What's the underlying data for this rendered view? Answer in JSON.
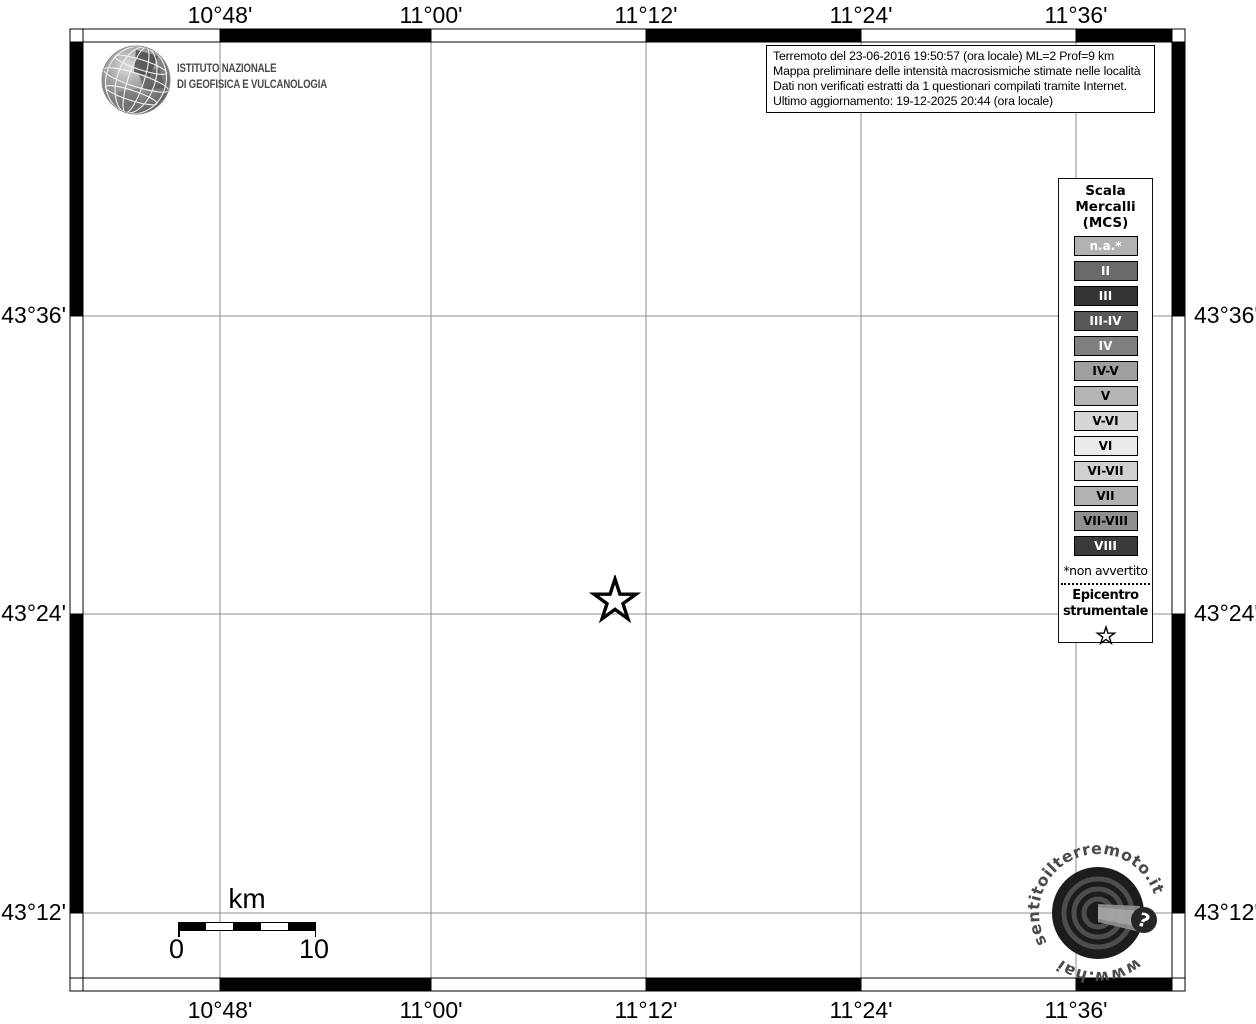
{
  "info_box": {
    "line1": "Terremoto del 23-06-2016 19:50:57 (ora locale) ML=2 Prof=9 km",
    "line2": "Mappa preliminare delle intensità macrosismiche stimate nelle località",
    "line3": "Dati non verificati estratti da 1 questionari compilati tramite Internet.",
    "line4": "Ultimo aggiornamento: 19-12-2025 20:44 (ora locale)"
  },
  "ingv_logo": {
    "line1": "ISTITUTO NAZIONALE",
    "line2": "DI GEOFISICA E VULCANOLOGIA"
  },
  "map": {
    "axis": {
      "lon": [
        "10°48'",
        "11°00'",
        "11°12'",
        "11°24'",
        "11°36'"
      ],
      "lat": [
        "43°36'",
        "43°24'",
        "43°12'"
      ]
    }
  },
  "legend": {
    "title1": "Scala",
    "title2": "Mercalli",
    "title3": "(MCS)",
    "items": [
      {
        "label": "n.a.*",
        "bg": "#b2b2b2",
        "fg": "#ffffff"
      },
      {
        "label": "II",
        "bg": "#696969",
        "fg": "#ffffff"
      },
      {
        "label": "III",
        "bg": "#333333",
        "fg": "#ffffff"
      },
      {
        "label": "III-IV",
        "bg": "#575757",
        "fg": "#ffffff"
      },
      {
        "label": "IV",
        "bg": "#7f7f7f",
        "fg": "#ffffff"
      },
      {
        "label": "IV-V",
        "bg": "#a0a0a0",
        "fg": "#000000"
      },
      {
        "label": "V",
        "bg": "#b5b5b5",
        "fg": "#000000"
      },
      {
        "label": "V-VI",
        "bg": "#d6d6d6",
        "fg": "#000000"
      },
      {
        "label": "VI",
        "bg": "#ebebeb",
        "fg": "#000000"
      },
      {
        "label": "VI-VII",
        "bg": "#d0d0d0",
        "fg": "#000000"
      },
      {
        "label": "VII",
        "bg": "#b2b2b2",
        "fg": "#000000"
      },
      {
        "label": "VII-VIII",
        "bg": "#8f8f8f",
        "fg": "#000000"
      },
      {
        "label": "VIII",
        "bg": "#3a3a3a",
        "fg": "#ffffff"
      }
    ],
    "footnote": "*non avvertito",
    "epicenter_line1": "Epicentro",
    "epicenter_line2": "strumentale"
  },
  "scale_bar": {
    "unit": "km",
    "start_label": "0",
    "end_label": "10"
  },
  "watermark": {
    "domain": "www.haisentitoilterremoto.it",
    "arc_top": "sentitoilterremoto.it",
    "arc_bottom": "www.hai",
    "badge": "?"
  }
}
